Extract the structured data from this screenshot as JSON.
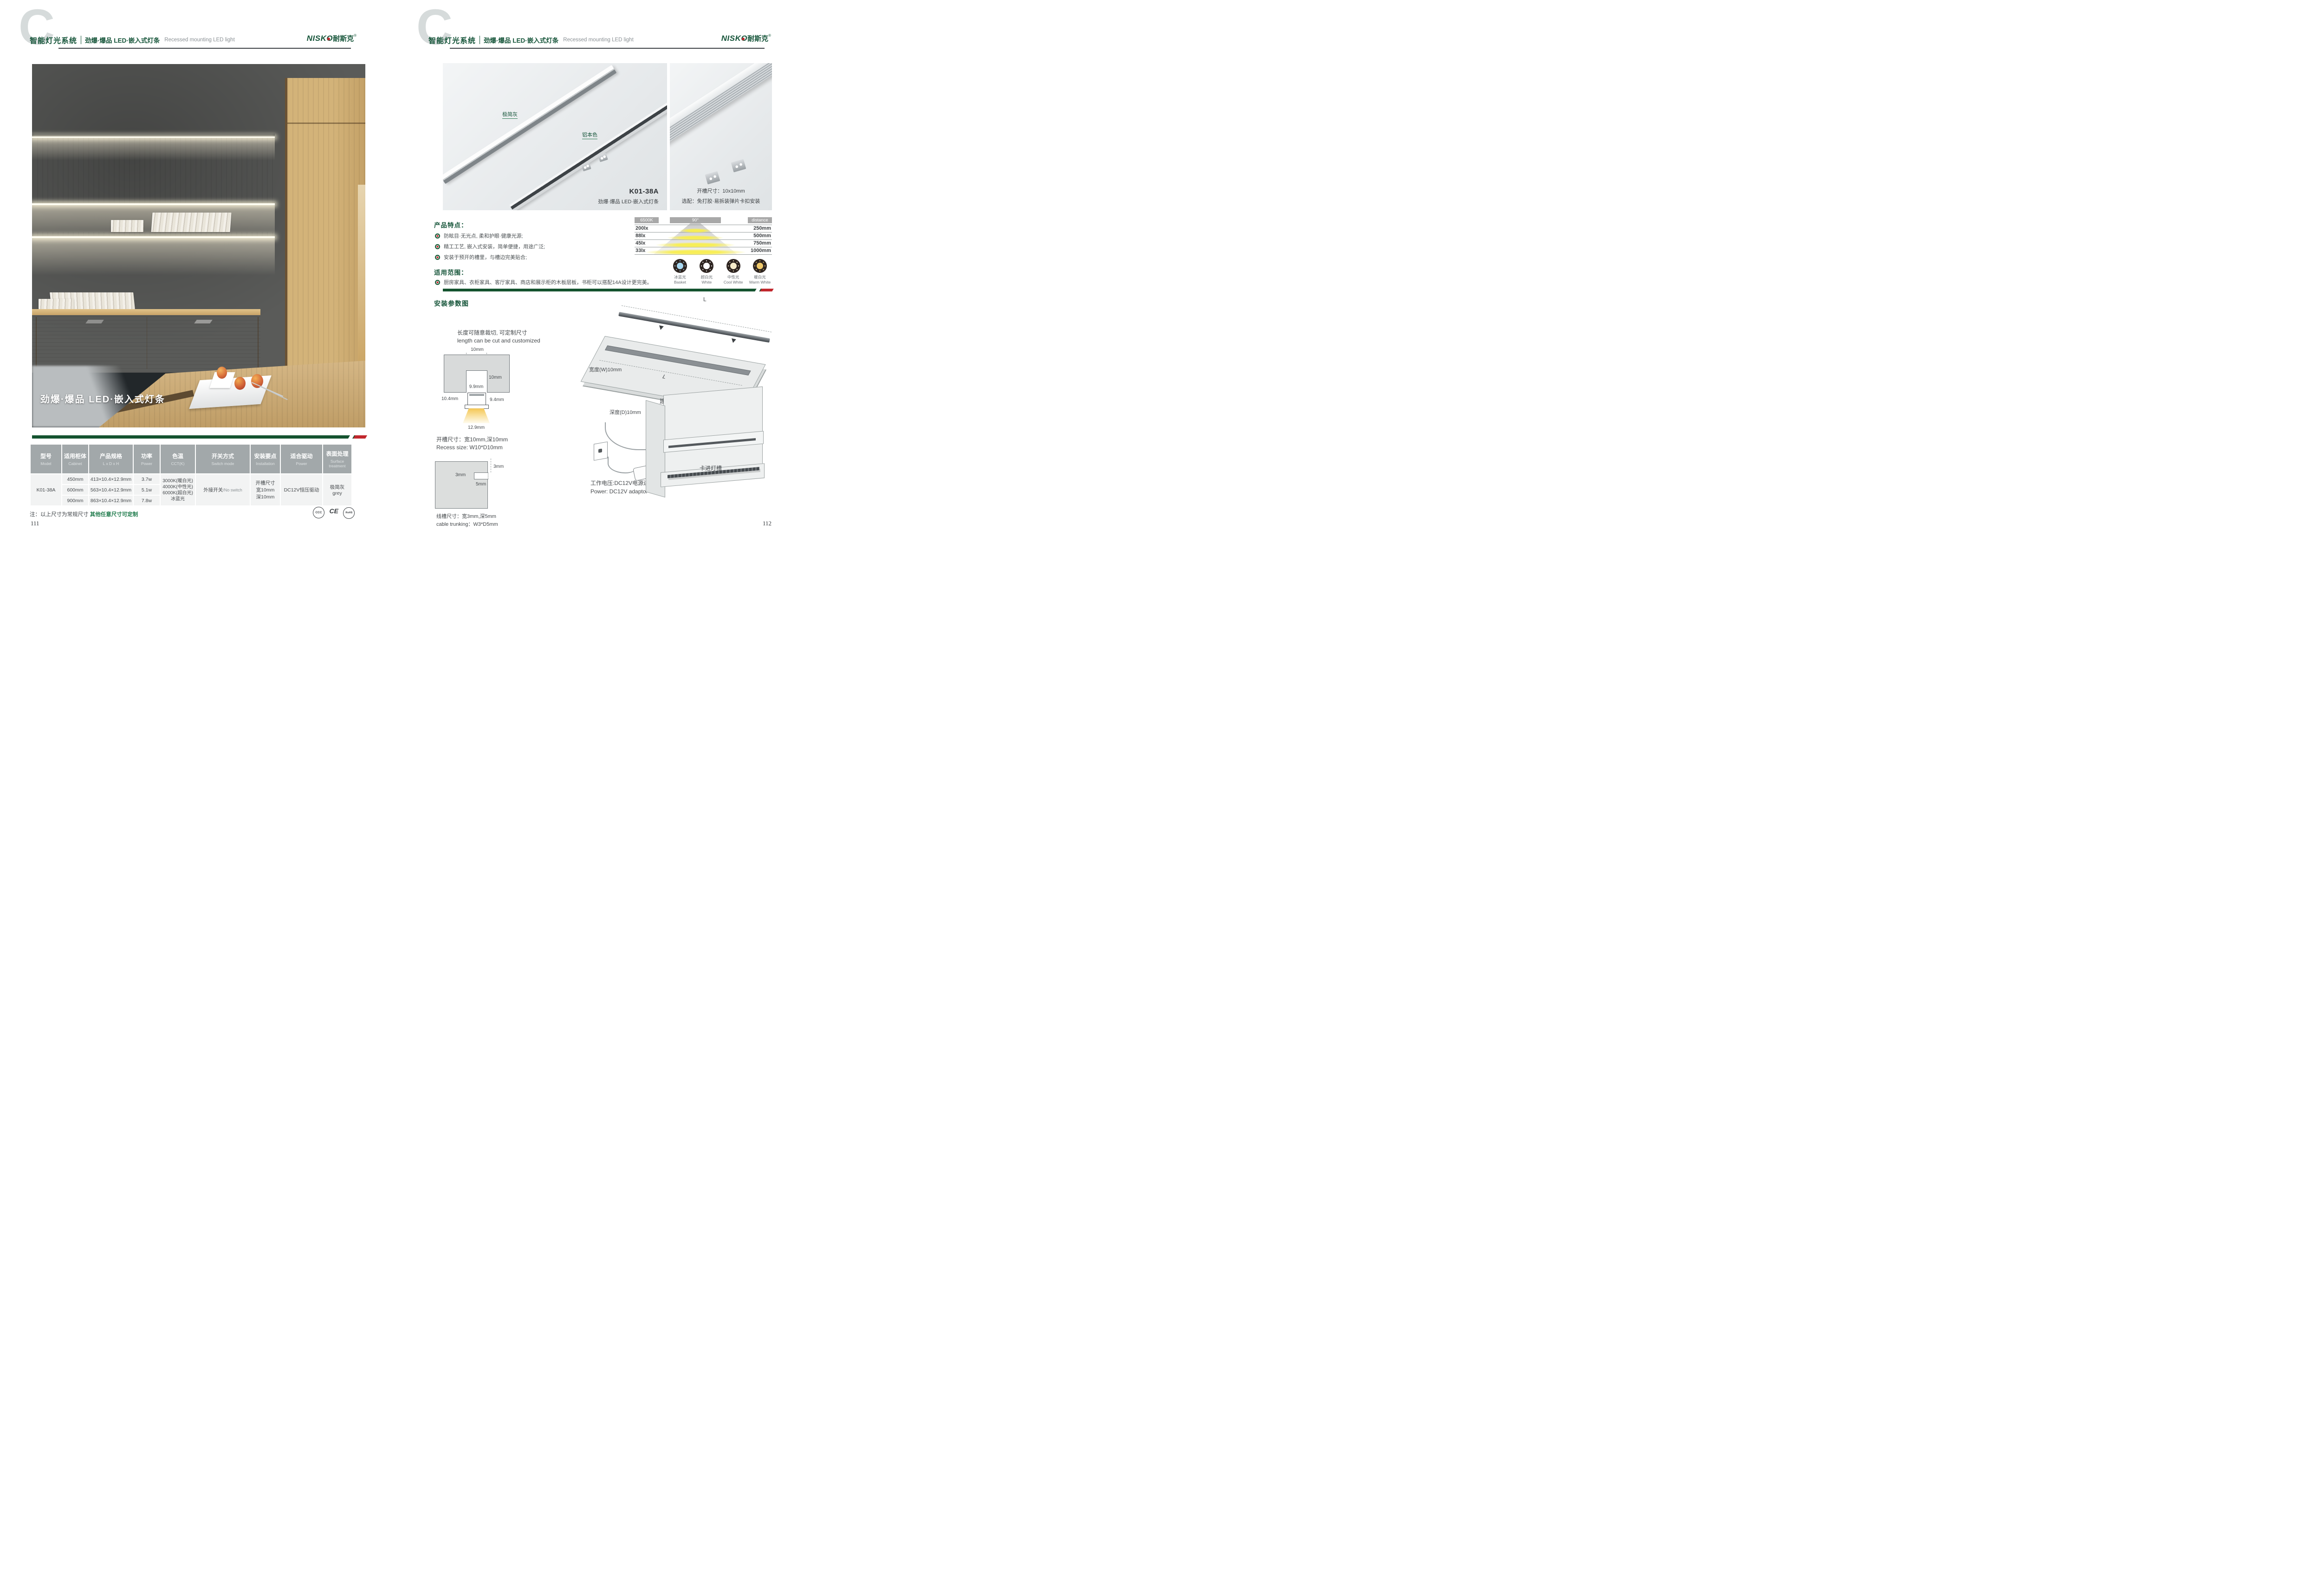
{
  "header": {
    "watermark": "C",
    "system_title": "智能灯光系统",
    "subtitle_cn": "劲爆·爆品  LED·嵌入式灯条",
    "subtitle_en": "Recessed mounting LED light",
    "logo_latin": "NISKO",
    "logo_cn": "耐斯克",
    "logo_reg": "®"
  },
  "left_page": {
    "photo_caption": "劲爆·爆品  LED·嵌入式灯条",
    "table": {
      "headers": [
        {
          "cn": "型号",
          "en": "Model"
        },
        {
          "cn": "适用柜体",
          "en": "Cabinet"
        },
        {
          "cn": "产品规格",
          "en": "L x D x H"
        },
        {
          "cn": "功率",
          "en": "Power"
        },
        {
          "cn": "色温",
          "en": "CCT(K)"
        },
        {
          "cn": "开关方式",
          "en": "Switch mode"
        },
        {
          "cn": "安装要点",
          "en": "Installation"
        },
        {
          "cn": "适合驱动",
          "en": "Power"
        },
        {
          "cn": "表面处理",
          "en": "Surface treatment"
        }
      ],
      "model": "K01-38A",
      "rows": [
        {
          "cabinet": "450mm",
          "size": "413×10.4×12.9mm",
          "power": "3.7w"
        },
        {
          "cabinet": "600mm",
          "size": "563×10.4×12.9mm",
          "power": "5.1w"
        },
        {
          "cabinet": "900mm",
          "size": "863×10.4×12.9mm",
          "power": "7.8w"
        }
      ],
      "cct_lines": [
        "3000K(暖白光)",
        "4000K(中性光)",
        "6000K(超白光)",
        "冰蓝光"
      ],
      "switch_cn": "外接开关",
      "switch_en": "/No switch",
      "install_lines": [
        "开槽尺寸",
        "宽10mm",
        "深10mm"
      ],
      "driver": "DC12V恒压驱动",
      "surface_lines": [
        "极简灰",
        "grey"
      ]
    },
    "note_prefix": "注：以上尺寸为常规尺寸 ",
    "note_highlight": "其他任意尺寸可定制",
    "certs": {
      "c1": "CCC",
      "c2": "CE",
      "c3": "RoHS"
    },
    "page_number": "111"
  },
  "right_page": {
    "photo1": {
      "label_gray": "极简灰",
      "label_alu": "铝本色",
      "model": "K01-38A",
      "caption": "劲爆·爆品  LED·嵌入式灯条"
    },
    "photo2": {
      "line1": "开槽尺寸：10x10mm",
      "line2": "选配：免打胶·易拆装弹片卡扣安装"
    },
    "features": {
      "title": "产品特点：",
      "items": [
        "防眩目·无光点, 柔和护眼·健康光源;",
        "精工工艺, 嵌入式安装，简单便捷，用途广泛;",
        "安装于预开的槽里，与槽边完美贴合;"
      ]
    },
    "scope": {
      "title": "适用范围：",
      "item": "厨房家具、衣柜家具、客厅家具、商店和展示柜的木板层板，书柜可以搭配14A设计更完美。"
    },
    "beam": {
      "cct": "6500K",
      "angle": "90°",
      "distance": "distance",
      "rows": [
        {
          "lux": "200lx",
          "mm": "250mm"
        },
        {
          "lux": "88lx",
          "mm": "500mm"
        },
        {
          "lux": "45lx",
          "mm": "750mm"
        },
        {
          "lux": "33lx",
          "mm": "1000mm"
        }
      ]
    },
    "light_colors": [
      {
        "cn": "冰蓝光",
        "en": "Basket",
        "color": "#a9d9f2"
      },
      {
        "cn": "超白光",
        "en": "White",
        "color": "#ffffff"
      },
      {
        "cn": "中性光",
        "en": "Cool White",
        "color": "#f6ecca"
      },
      {
        "cn": "暖白光",
        "en": "Warm White",
        "color": "#f0c96a"
      }
    ],
    "install": {
      "title": "安装参数图",
      "cut_cn": "长度可随意裁切, 可定制尺寸",
      "cut_en": "length can be cut and customized",
      "cs": {
        "top": "10mm",
        "depth": "10mm",
        "inner": "9.9mm",
        "left": "10.4mm",
        "right": "9.4mm",
        "bottom": "12.9mm"
      },
      "recess_cn": "开槽尺寸：宽10mm,深10mm",
      "recess_en": "Recess size: W10*D10mm",
      "trunk": {
        "t": "3mm",
        "w": "3mm",
        "d": "5mm"
      },
      "trunk_cn": "线槽尺寸：宽3mm,深5mm",
      "trunk_en": "cable trunking：W3*D5mm",
      "board": {
        "l_top": "L",
        "w_label": "宽度(W)10mm",
        "l_mid": "L",
        "d_label": "深度(D)10mm",
        "caption": "建议开槽尺寸"
      },
      "power_cn": "工作电压:DC12V电源适配器",
      "power_en": "Power: DC12V adaptor",
      "clip_label": "卡进灯槽"
    },
    "page_number": "112"
  }
}
